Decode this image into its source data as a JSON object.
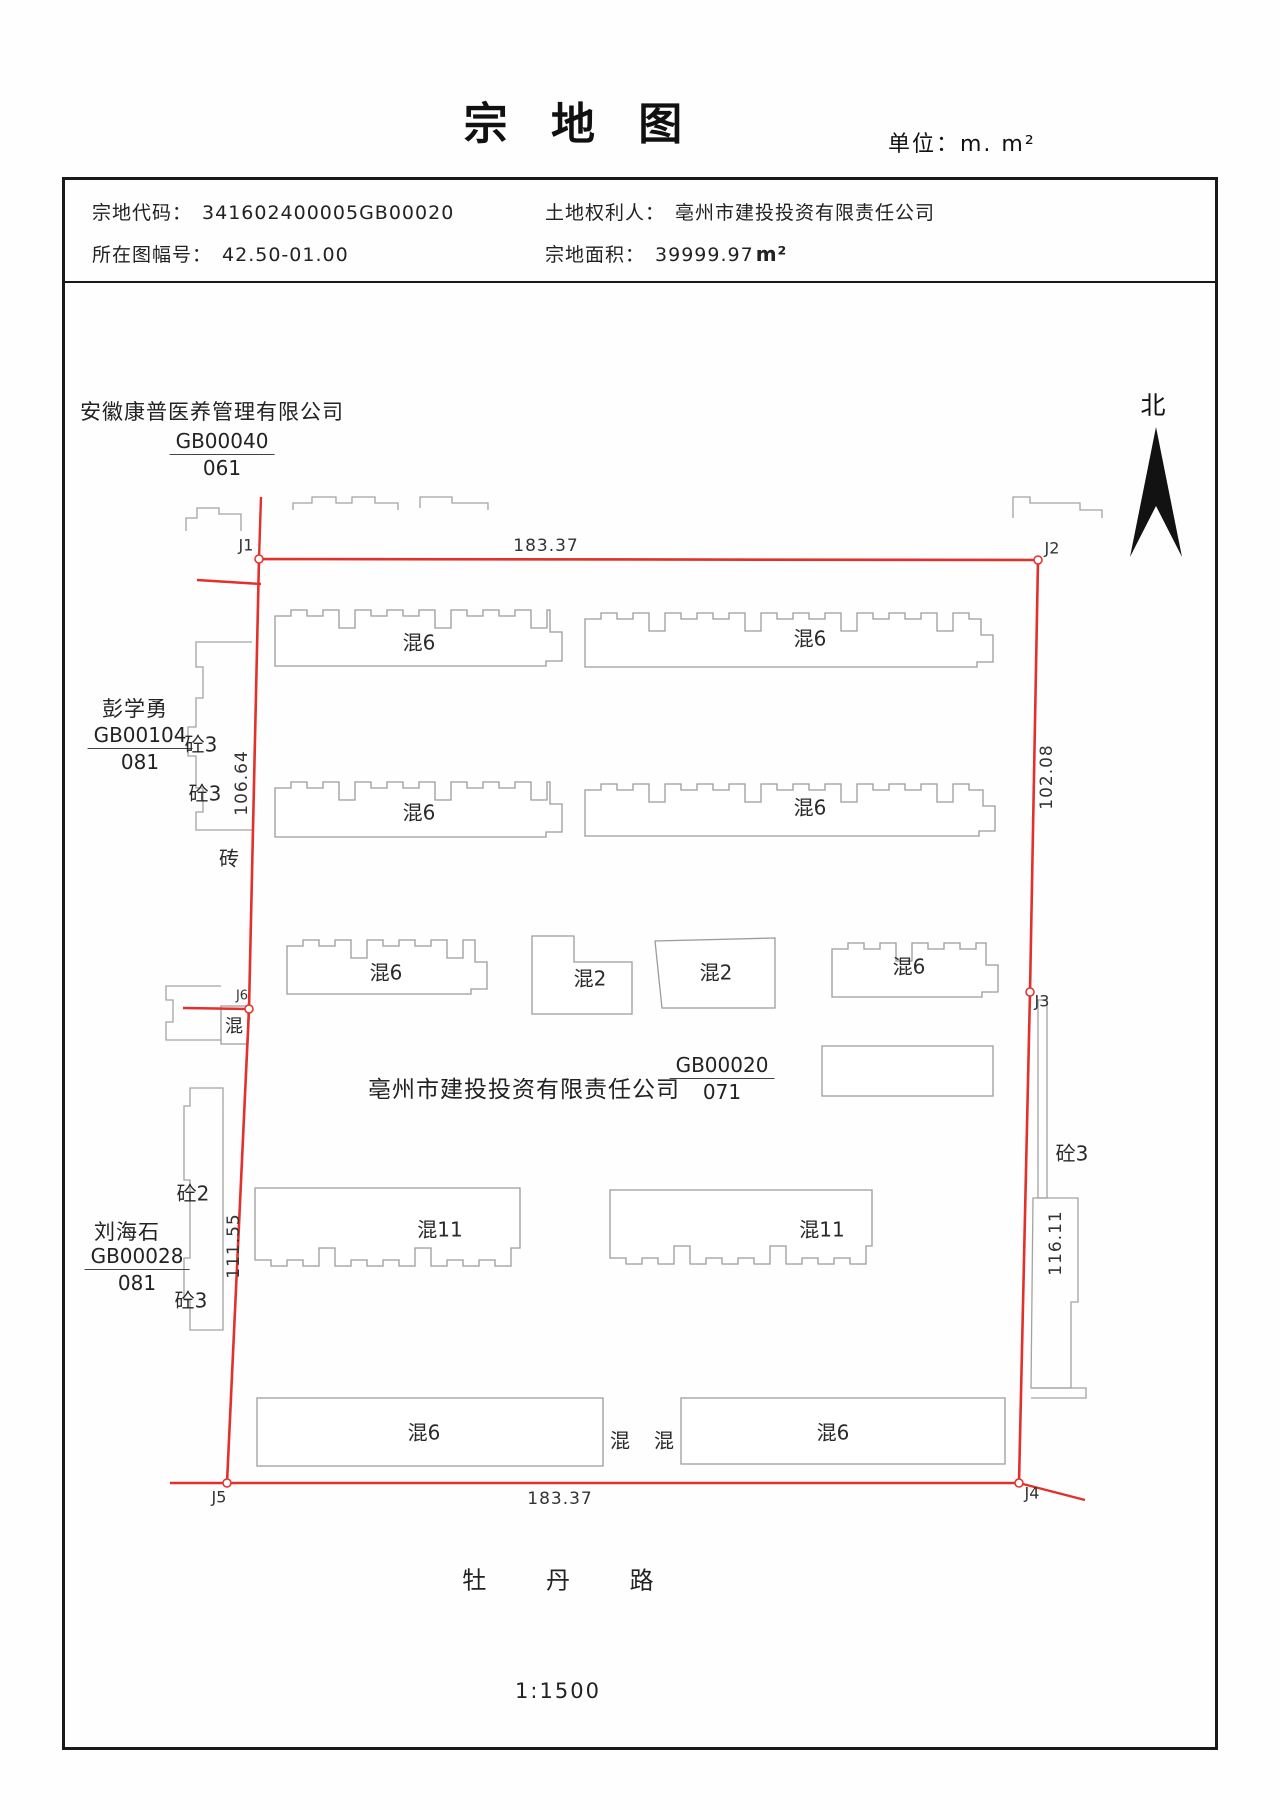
{
  "title": "宗 地 图",
  "unit_note": "单位：m. m²",
  "header": {
    "parcel_code_label": "宗地代码：",
    "parcel_code": "341602400005GB00020",
    "sheet_label": "所在图幅号：",
    "sheet_no": "42.50-01.00",
    "owner_label": "土地权利人：",
    "owner_name": "亳州市建投投资有限责任公司",
    "area_label": "宗地面积：",
    "area_value": "39999.97",
    "area_unit": "m²"
  },
  "compass": {
    "label": "北"
  },
  "parcel": {
    "owner_annotation": "亳州市建投投资有限责任公司",
    "code": "GB00020",
    "sub_code": "071"
  },
  "neighbors": {
    "north": {
      "name": "安徽康普医养管理有限公司",
      "code": "GB00040",
      "sub_code": "061"
    },
    "west_upper": {
      "name": "彭学勇",
      "code": "GB00104",
      "sub_code": "081"
    },
    "west_lower": {
      "name": "刘海石",
      "code": "GB00028",
      "sub_code": "081"
    }
  },
  "boundary_points": {
    "j1": "J1",
    "j2": "J2",
    "j3": "J3",
    "j4": "J4",
    "j5": "J5",
    "j6": "J6"
  },
  "dimensions": {
    "top": "183.37",
    "bottom": "183.37",
    "left_upper": "106.64",
    "left_lower": "111.55",
    "right_upper": "102.08",
    "right_lower": "116.11"
  },
  "buildings": [
    {
      "label": "混6"
    },
    {
      "label": "混6"
    },
    {
      "label": "混6"
    },
    {
      "label": "混6"
    },
    {
      "label": "混6"
    },
    {
      "label": "混2"
    },
    {
      "label": "混2"
    },
    {
      "label": "混6"
    },
    {
      "label": "混11"
    },
    {
      "label": "混11"
    },
    {
      "label": "混6"
    },
    {
      "label": "混"
    },
    {
      "label": "混"
    },
    {
      "label": "混6"
    },
    {
      "label": "混"
    }
  ],
  "annotations": {
    "tong3_a": "砼3",
    "tong3_b": "砼3",
    "zhuan": "砖",
    "tong2": "砼2",
    "tong3_c": "砼3",
    "tong3_right": "砼3"
  },
  "road_name": "牡 丹 路",
  "scale_text": "1:1500",
  "colors": {
    "boundary_red": "#e2302a",
    "building_gray": "#9c9c9c"
  }
}
